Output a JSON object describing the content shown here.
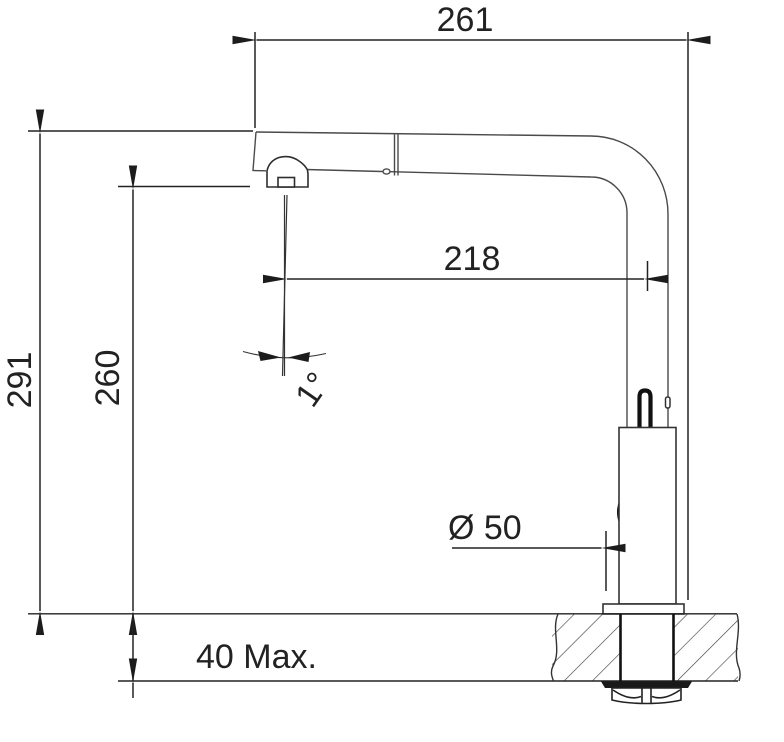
{
  "drawing": {
    "kind": "faucet-installation-dimension-drawing",
    "colors": {
      "background": "#ffffff",
      "dimension_line": "#222222",
      "body_line": "#4a4a4a",
      "heavy_line": "#111111",
      "hatch_line": "#3d3d3d",
      "text": "#222222"
    },
    "labels": {
      "width_total": "261",
      "spout_reach": "218",
      "height_total": "291",
      "height_spout": "260",
      "spout_angle": "1°",
      "base_diameter": "Ø 50",
      "deck_thickness": "40 Max."
    }
  }
}
